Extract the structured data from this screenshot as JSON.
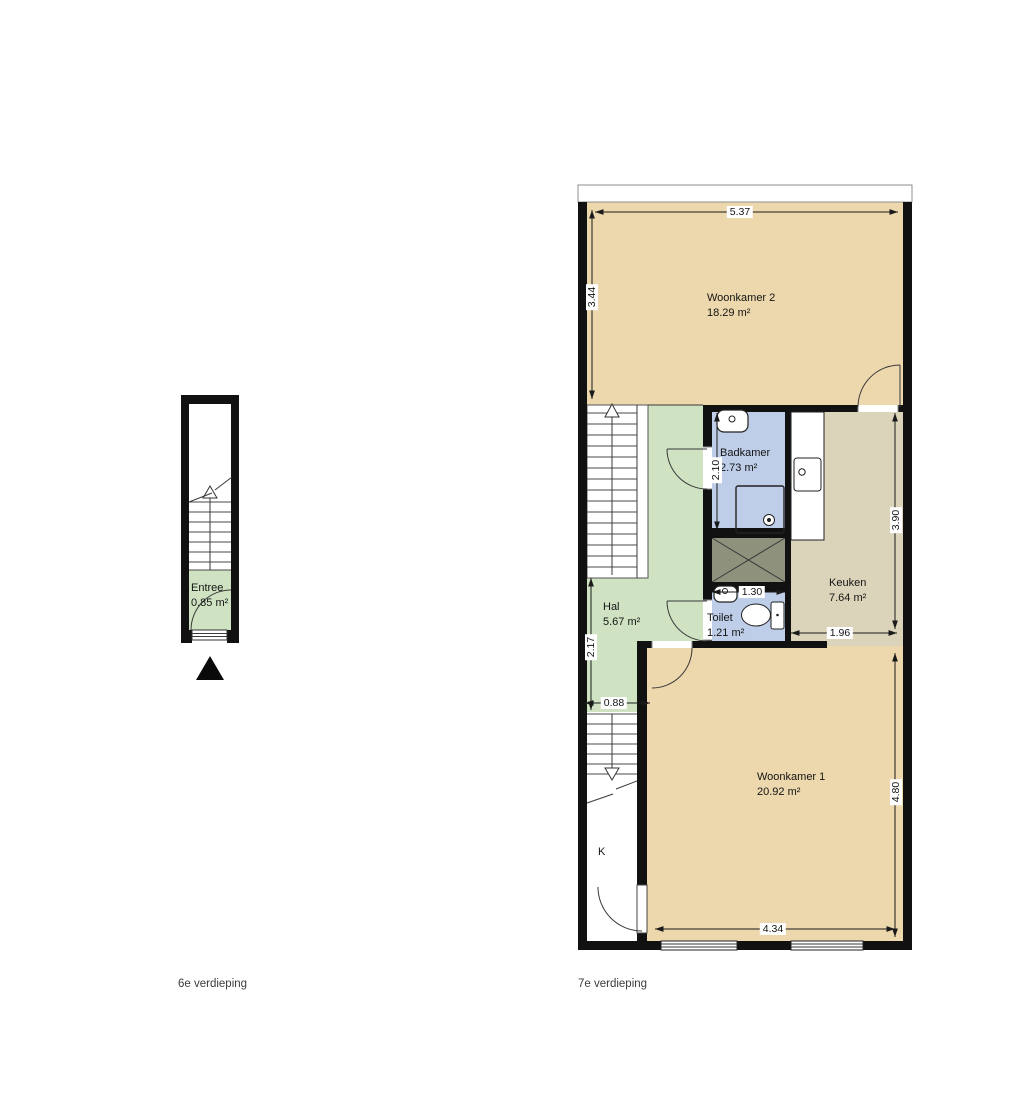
{
  "floors": [
    {
      "label": "6e verdieping",
      "rooms": [
        {
          "name": "Entree",
          "area": "0.85 m²"
        }
      ]
    },
    {
      "label": "7e verdieping",
      "closet_label": "K",
      "rooms": [
        {
          "name": "Woonkamer 2",
          "area": "18.29 m²"
        },
        {
          "name": "Badkamer",
          "area": "2.73 m²"
        },
        {
          "name": "Keuken",
          "area": "7.64 m²"
        },
        {
          "name": "Hal",
          "area": "5.67 m²"
        },
        {
          "name": "Toilet",
          "area": "1.21 m²"
        },
        {
          "name": "Woonkamer 1",
          "area": "20.92 m²"
        }
      ],
      "dimensions": {
        "top_width": "5.37",
        "left_height": "3.44",
        "bathroom_height": "2.10",
        "kitchen_height": "3.90",
        "toilet_width": "1.30",
        "kitchen_width": "1.96",
        "hall_height": "2.17",
        "stair_width": "0.88",
        "living1_height": "4.80",
        "living1_width": "4.34"
      }
    }
  ],
  "colors": {
    "wall": "#111111",
    "room-living": "#ecd8ac",
    "room-kitchen": "#dcd4ba",
    "room-hall": "#cfe3c3",
    "room-bath": "#becde8",
    "shaft": "#8e927d"
  }
}
